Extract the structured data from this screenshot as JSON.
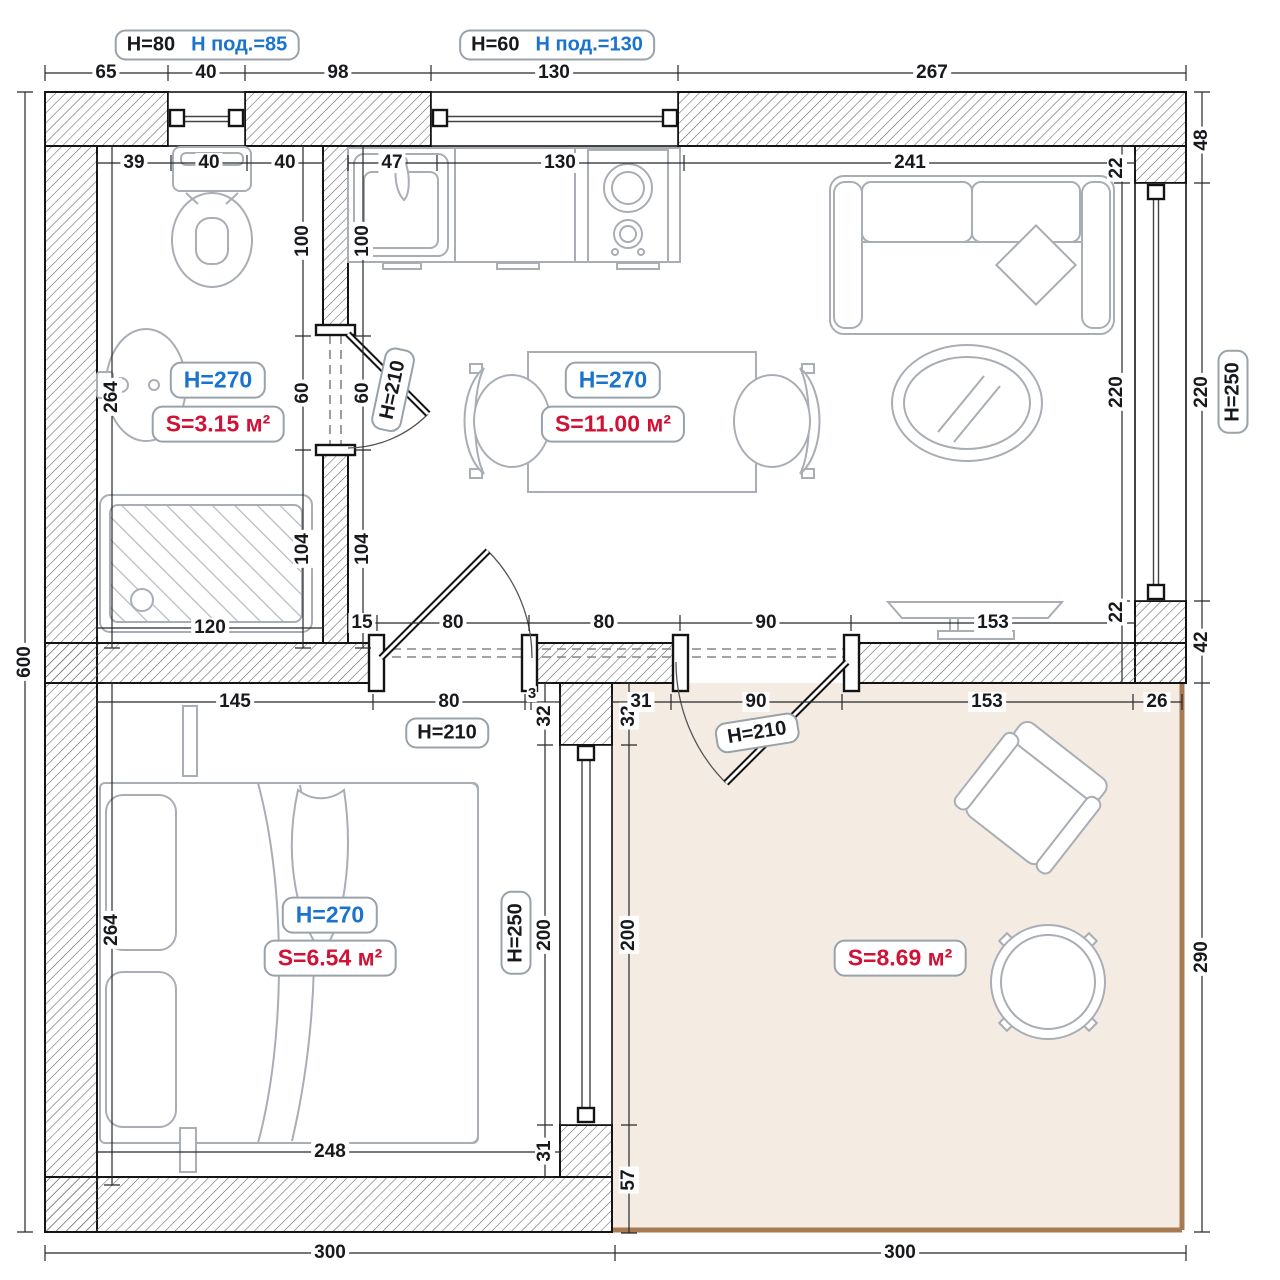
{
  "callouts": {
    "left": {
      "black": "H=80",
      "blue": "H под.=85"
    },
    "mid": {
      "black": "H=60",
      "blue": "H под.=130"
    }
  },
  "rooms": {
    "bathroom": {
      "h": "H=270",
      "s": "S=3.15 м²"
    },
    "kitchen": {
      "h": "H=270",
      "s": "S=11.00 м²"
    },
    "bedroom": {
      "h": "H=270",
      "s": "S=6.54 м²"
    },
    "balcony": {
      "s": "S=8.69 м²"
    }
  },
  "doors": {
    "bath": "H=210",
    "bedroom": "H=210",
    "balcony": "H=210"
  },
  "windows": {
    "right": "H=250",
    "middle": "H=250"
  },
  "dims": {
    "top": [
      "65",
      "40",
      "98",
      "130",
      "267"
    ],
    "bottom": [
      "300",
      "300"
    ],
    "left_total": "600",
    "right_outer": [
      "48",
      "220",
      "42",
      "290"
    ],
    "right_inner": [
      "22",
      "220",
      "22"
    ],
    "bathroom_top": [
      "39",
      "40",
      "40"
    ],
    "kitchen_top": [
      "47",
      "130",
      "241"
    ],
    "bathroom_left": "264",
    "wall_col": [
      "100",
      "60",
      "104"
    ],
    "shower_width": "120",
    "hall_upper": [
      "15",
      "80",
      "80",
      "90",
      "153"
    ],
    "bedroom_top": [
      "145",
      "80",
      "3"
    ],
    "wall_stub": [
      "32",
      "32"
    ],
    "balcony_top": [
      "31",
      "90",
      "153",
      "26"
    ],
    "middle_window": {
      "left": "200",
      "right": "200",
      "below_left": "31",
      "below_right": "57"
    },
    "bedroom_left": "264",
    "bedroom_bottom": "248"
  }
}
